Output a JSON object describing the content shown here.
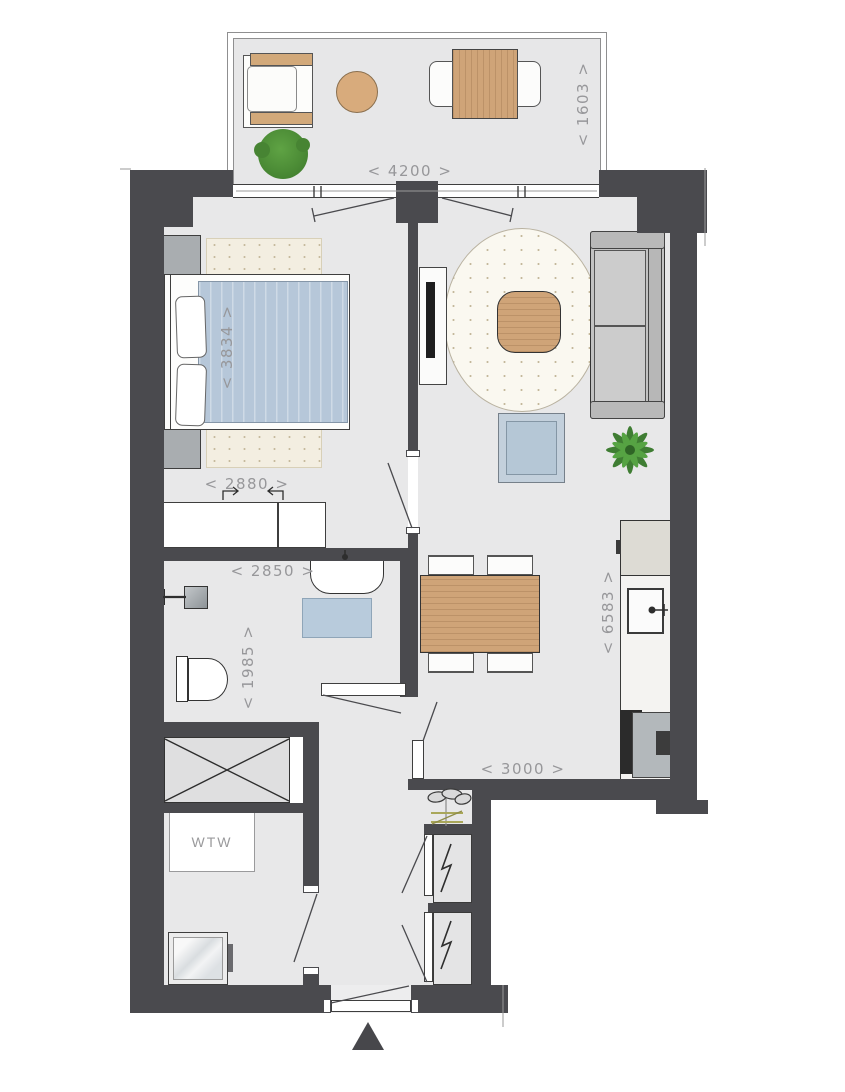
{
  "type": "apartment-floor-plan",
  "labels": {
    "balcony_width": "< 4200 >",
    "balcony_depth": "< 1603 >",
    "bed_length": "< 3834 >",
    "bedroom_width": "< 2880 >",
    "bathroom_width": "< 2850 >",
    "bathroom_depth": "< 1985 >",
    "kitchen_wall_length": "< 6583 >",
    "hall_width": "< 3000 >",
    "ventilation_unit": "WTW"
  },
  "colors": {
    "wall": "#4a4a4e",
    "floor": "#e8e8e9",
    "balcony_floor": "#e7e7e8",
    "dimension_text": "#97979a",
    "wood": "#cfa478",
    "textile_blue": "#b6c7d9",
    "rug_cream": "#f3eee1",
    "sofa_gray": "#c2c2c2",
    "plant_green": "#4e8f3a",
    "accent_olive": "#a9a75a"
  }
}
